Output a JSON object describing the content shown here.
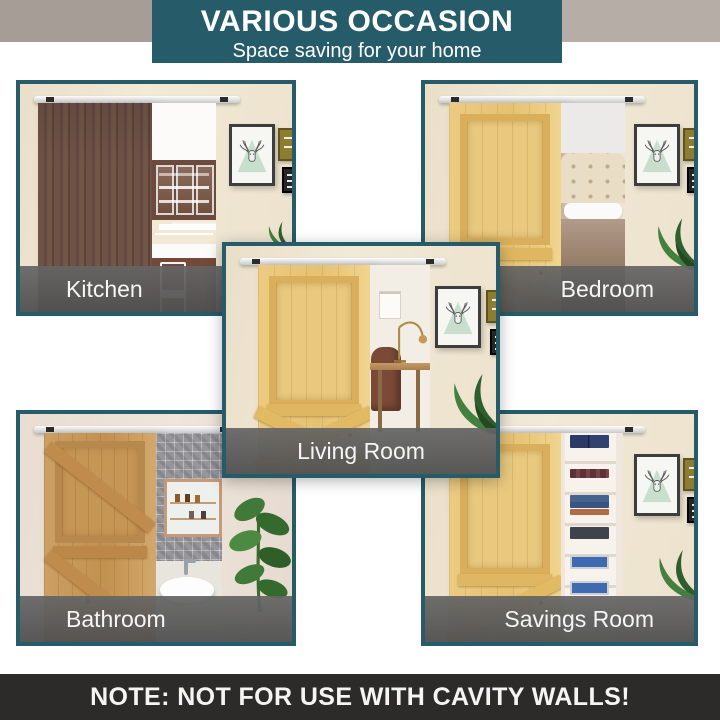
{
  "header": {
    "title": "VARIOUS OCCASION",
    "subtitle": "Space saving for your home"
  },
  "panels": {
    "kitchen": {
      "label": "Kitchen"
    },
    "bedroom": {
      "label": "Bedroom"
    },
    "living": {
      "label": "Living Room"
    },
    "bathroom": {
      "label": "Bathroom"
    },
    "savings": {
      "label": "Savings Room"
    }
  },
  "footer": {
    "note": "NOTE: NOT FOR USE WITH CAVITY WALLS!"
  },
  "icons": {
    "deer_art": "deer-triangle-art-icon",
    "plant": "plant-leaf-icon",
    "rail": "sliding-rail"
  },
  "colors": {
    "accent_teal": "#265b6a",
    "label_band_gray": "#5a5a5a",
    "note_bar": "#2d2b2a",
    "wall_cream": "#f0e7d4",
    "top_strip_gray": "#aca39d"
  }
}
